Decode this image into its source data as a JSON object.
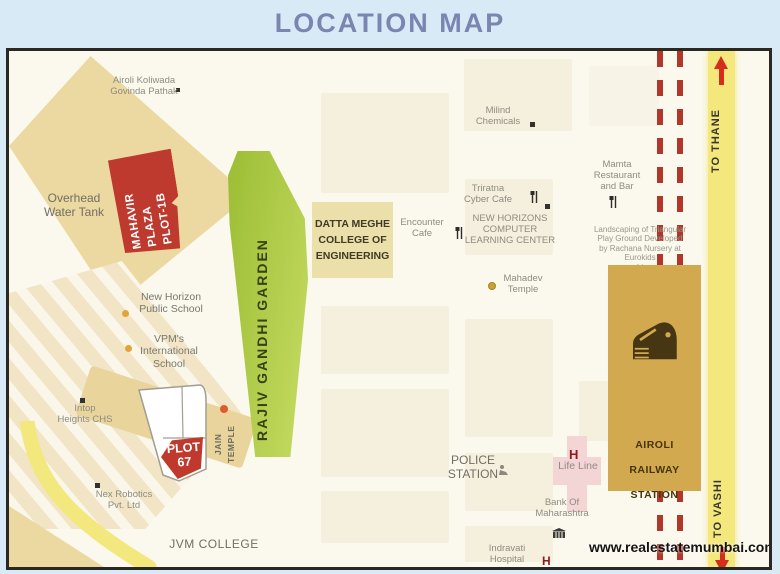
{
  "title": "LOCATION MAP",
  "watermark": "www.realestatemumbai.com",
  "colors": {
    "header_bg": "#d8eaf5",
    "title_text": "#7b85b1",
    "plaza_red": "#bf3a2e",
    "garden_green": "#aecb44",
    "college_khaki": "#ebdfaa",
    "station_tan": "#d2a94f",
    "road_yellow": "#f4e87d",
    "railway_red": "#b2372b",
    "arrow_red": "#d42d1e"
  },
  "map": {
    "plots": {
      "mahavir": {
        "label": "MAHAVIR\nPLAZA\nPLOT-1B"
      },
      "garden": {
        "label": "RAJIV GANDHI GARDEN"
      },
      "college": {
        "label": "DATTA MEGHE\nCOLLEGE OF\nENGINEERING"
      },
      "station": {
        "label": "AIROLI\nRAILWAY\nSTATION"
      },
      "plot67": {
        "label": "PLOT\n67"
      }
    },
    "roads": {
      "to_thane": "TO THANE",
      "to_vashi": "TO VASHI"
    },
    "hospital_marker": "H",
    "labels": [
      {
        "id": "airoli-koliwada",
        "text": "Airoli Koliwada\nGovinda Pathak"
      },
      {
        "id": "milind-chemicals",
        "text": "Milind\nChemicals"
      },
      {
        "id": "mamta-restaurant",
        "text": "Mamta\nRestaurant\nand Bar"
      },
      {
        "id": "overhead-water-tank",
        "text": "Overhead\nWater Tank"
      },
      {
        "id": "triratna-cyber-cafe",
        "text": "Triratna\nCyber Cafe"
      },
      {
        "id": "encounter-cafe",
        "text": "Encounter\nCafe"
      },
      {
        "id": "new-horizons-center",
        "text": "NEW HORIZONS\nCOMPUTER\nLEARNING CENTER"
      },
      {
        "id": "landscaping-note",
        "text": "Landscaping of Triangular\nPlay Ground Developed\nby Rachana Nursery at\nEurokids\nLi"
      },
      {
        "id": "mahadev-temple",
        "text": "Mahadev\nTemple"
      },
      {
        "id": "new-horizon-school",
        "text": "New Horizon\nPublic School"
      },
      {
        "id": "vpm-school",
        "text": "VPM's\nInternational\nSchool"
      },
      {
        "id": "intop-heights",
        "text": "Intop\nHeights CHS"
      },
      {
        "id": "jain-temple",
        "text": "JAIN\nTEMPLE"
      },
      {
        "id": "nex-robotics",
        "text": "Nex Robotics\nPvt. Ltd"
      },
      {
        "id": "jvm-college",
        "text": "JVM COLLEGE"
      },
      {
        "id": "police-station",
        "text": "POLICE\nSTATION"
      },
      {
        "id": "life-line",
        "text": "Life Line"
      },
      {
        "id": "bank-of-maharashtra",
        "text": "Bank Of\nMaharashtra"
      },
      {
        "id": "indravati-hospital",
        "text": "Indravati\nHospital"
      }
    ]
  }
}
